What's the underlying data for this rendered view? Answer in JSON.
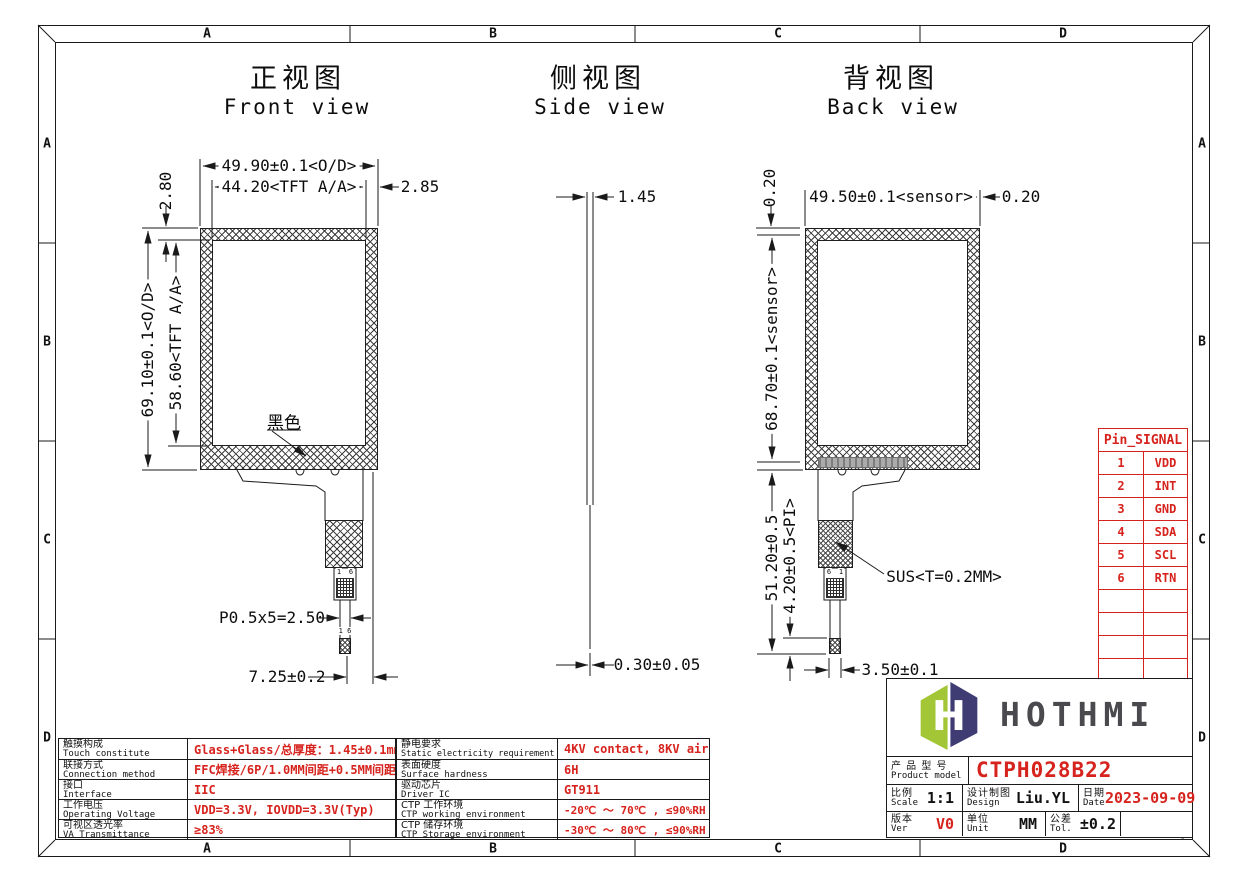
{
  "frame": {
    "cols": [
      "A",
      "B",
      "C",
      "D"
    ],
    "rows": [
      "A",
      "B",
      "C",
      "D"
    ]
  },
  "views": {
    "front": {
      "title_cn": "正视图",
      "title_en": "Front view",
      "dims": {
        "od_width": "49.90±0.1<O/D>",
        "aa_width": "44.20<TFT A/A>",
        "right_margin": "2.85",
        "top_margin": "2.80",
        "od_height": "69.10±0.1<O/D>",
        "aa_height": "58.60<TFT A/A>",
        "pitch": "P0.5x5=2.50",
        "tail_width": "7.25±0.2"
      },
      "labels": {
        "black_print": "黑色",
        "pin_first": "1",
        "pin_last": "6",
        "tip_pins": "1 6"
      }
    },
    "side": {
      "title_cn": "侧视图",
      "title_en": "Side view",
      "dims": {
        "thickness": "1.45",
        "ffc_thickness": "0.30±0.05"
      }
    },
    "back": {
      "title_cn": "背视图",
      "title_en": "Back view",
      "dims": {
        "sensor_width": "49.50±0.1<sensor>",
        "margin_right": "0.20",
        "margin_top": "0.20",
        "sensor_height": "68.70±0.1<sensor>",
        "tail_length": "51.20±0.5",
        "pi_length": "4.20±0.5<PI>",
        "tip_width": "3.50±0.1"
      },
      "labels": {
        "sus": "SUS<T=0.2MM>",
        "pin_first": "6",
        "pin_last": "1"
      }
    }
  },
  "pin_table": {
    "header": "Pin_SIGNAL",
    "rows": [
      [
        "1",
        "VDD"
      ],
      [
        "2",
        "INT"
      ],
      [
        "3",
        "GND"
      ],
      [
        "4",
        "SDA"
      ],
      [
        "5",
        "SCL"
      ],
      [
        "6",
        "RTN"
      ]
    ]
  },
  "spec_left": {
    "rows": [
      {
        "cn": "触摸构成",
        "en": "Touch constitute",
        "value": "Glass+Glass/总厚度：1.45±0.1mm"
      },
      {
        "cn": "联接方式",
        "en": "Connection method",
        "value": "FFC焊接/6P/1.0MM间距+0.5MM间距"
      },
      {
        "cn": "接口",
        "en": "Interface",
        "value": "IIC"
      },
      {
        "cn": "工作电压",
        "en": "Operating Voltage",
        "value": "VDD=3.3V, IOVDD=3.3V(Typ)"
      },
      {
        "cn": "可视区透光率",
        "en": "VA Transmittance",
        "value": "≥83%"
      }
    ]
  },
  "spec_mid": {
    "rows": [
      {
        "cn": "静电要求",
        "en": "Static electricity requirement",
        "value": "4KV contact, 8KV air"
      },
      {
        "cn": "表面硬度",
        "en": "Surface hardness",
        "value": "6H"
      },
      {
        "cn": "驱动芯片",
        "en": "Driver IC",
        "value": "GT911"
      },
      {
        "cn": "CTP 工作环境",
        "en": "CTP working environment",
        "value": "-20℃ ～ 70℃ , ≤90%RH"
      },
      {
        "cn": "CTP 储存环境",
        "en": "CTP Storage environment",
        "value": "-30℃ ～ 80℃ , ≤90%RH"
      }
    ]
  },
  "title_block": {
    "brand": "HOTHMI",
    "product": {
      "cn": "产 品 型 号",
      "en": "Product model",
      "value": "CTPH028B22"
    },
    "scale": {
      "cn": "比例",
      "en": "Scale",
      "value": "1:1"
    },
    "design": {
      "cn": "设计制图",
      "en": "Design",
      "value": "Liu.YL"
    },
    "date": {
      "cn": "日期",
      "en": "Date",
      "value": "2023-09-09"
    },
    "version": {
      "cn": "版本",
      "en": "Ver",
      "value": "V0"
    },
    "unit": {
      "cn": "单位",
      "en": "Unit",
      "value": "MM"
    },
    "tolerance": {
      "cn": "公差",
      "en": "Tol.",
      "value": "±0.2"
    }
  },
  "colors": {
    "accent_red": "#d7231d",
    "logo_green": "#a3c636",
    "logo_navy": "#3e3c72",
    "line": "#1a1a1a"
  }
}
